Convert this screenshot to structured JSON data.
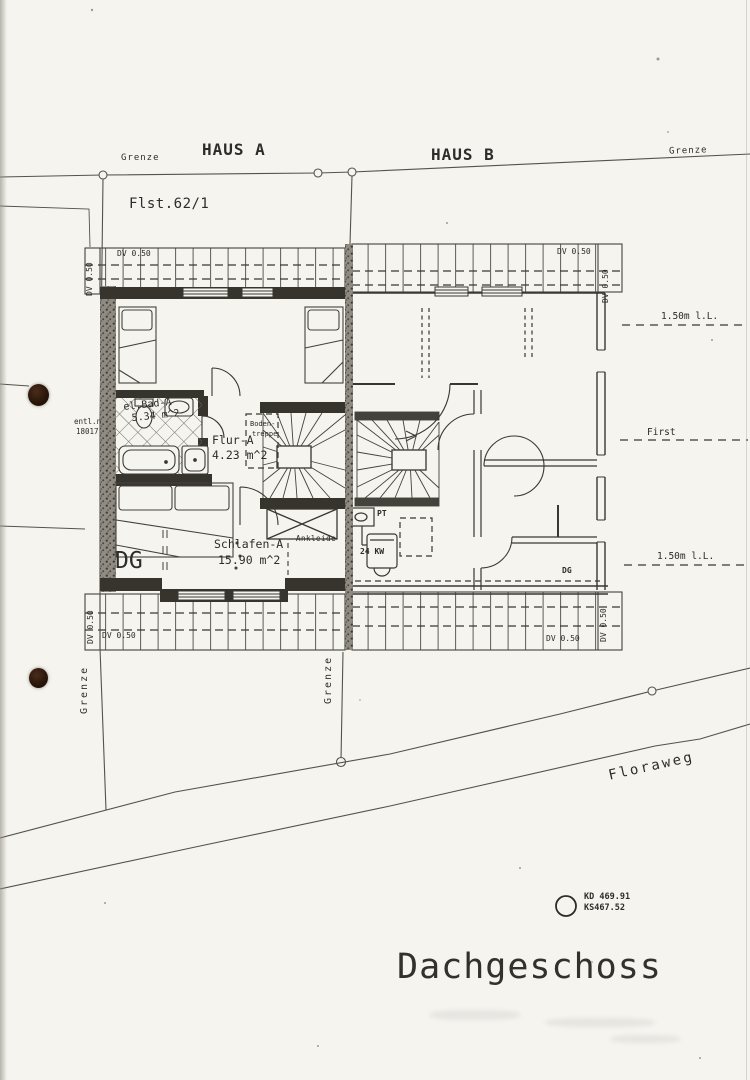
{
  "site": {
    "grenze": "Grenze",
    "haus_a": "HAUS A",
    "haus_b": "HAUS B",
    "parcel": "Flst.62/1",
    "street": "Floraweg"
  },
  "roof": {
    "overhang": "DV 0.50",
    "ridge": "First",
    "height_line": "1.50m l.L."
  },
  "rooms": {
    "bath_name": "el.Bad-A",
    "bath_area": "5.34 m^2",
    "hall_name": "Flur-A",
    "hall_area": "4.23 m^2",
    "bedroom_name": "Schlafen-A",
    "bedroom_area": "15.90 m^2",
    "dressing": "Ankleide",
    "attic_stair_1": "Boden-",
    "attic_stair_2": "treppe"
  },
  "tags": {
    "floor_a": "DG",
    "floor_b": "DG",
    "pt": "PT",
    "boiler": "24 KW",
    "vent_1": "entl.n",
    "vent_2": "18017"
  },
  "survey": {
    "cover": "KD 469.91",
    "invert": "KS467.52"
  },
  "title": "Dachgeschoss",
  "colors": {
    "paper": "#f5f4ef",
    "ink": "#2e2c28",
    "wall": "#37342e",
    "punch": "#2a160b"
  }
}
